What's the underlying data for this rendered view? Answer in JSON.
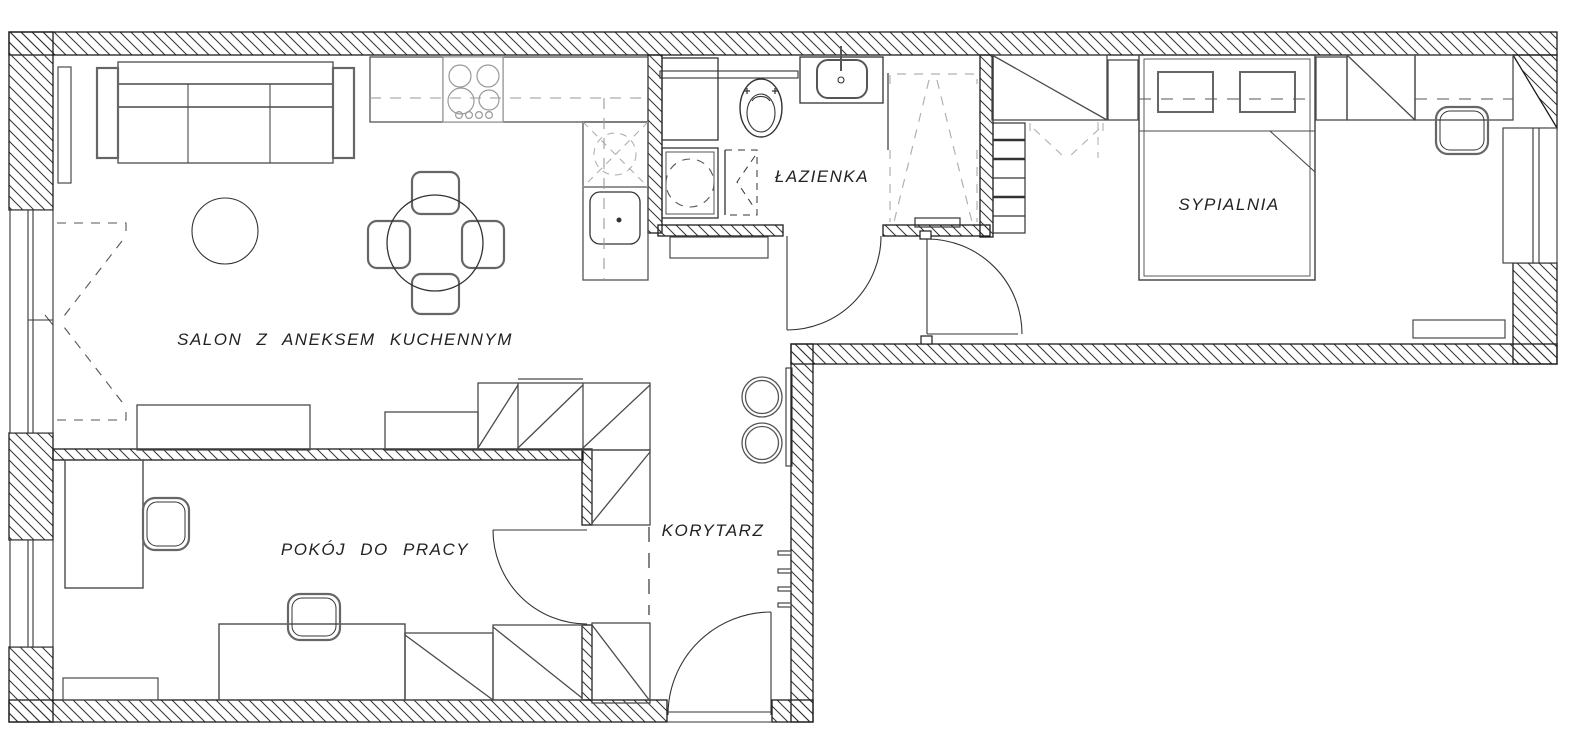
{
  "title": "Apartment floor plan",
  "colors": {
    "background": "#ffffff",
    "wall_line": "#1c1c1c",
    "hatch_line": "#333333",
    "furniture_line": "#4a4a4a",
    "light_line": "#999999",
    "dash_line": "#aaaaaa",
    "text": "#222222"
  },
  "rooms": [
    {
      "id": "salon",
      "label": "SALON Z ANEKSEM KUCHENNYM",
      "furniture": [
        "sofa",
        "side-shelf",
        "round-rug",
        "dining-table",
        "four-chairs",
        "kitchen-counter",
        "cooktop",
        "kitchen-sink",
        "corner-cabinet",
        "tv-bench",
        "bench",
        "wardrobe"
      ]
    },
    {
      "id": "lazienka",
      "label": "ŁAZIENKA",
      "furniture": [
        "toilet",
        "washbasin",
        "shower",
        "washing-machine",
        "tall-cabinet",
        "folding-door"
      ]
    },
    {
      "id": "sypialnia",
      "label": "SYPIALNIA",
      "furniture": [
        "double-bed",
        "pillows",
        "nightstand-left",
        "nightstand-right",
        "wardrobe",
        "desk",
        "chair",
        "radiator",
        "shelving-unit",
        "closet"
      ]
    },
    {
      "id": "pokoj",
      "label": "POKÓJ DO PRACY",
      "furniture": [
        "desk-left",
        "chair-left",
        "desk-bottom",
        "chair-bottom",
        "radiator",
        "wardrobe-sections"
      ]
    },
    {
      "id": "korytarz",
      "label": "KORYTARZ",
      "furniture": [
        "entrance-door",
        "coat-hooks",
        "wall-shelf",
        "two-stools",
        "wardrobe-sections"
      ]
    }
  ]
}
